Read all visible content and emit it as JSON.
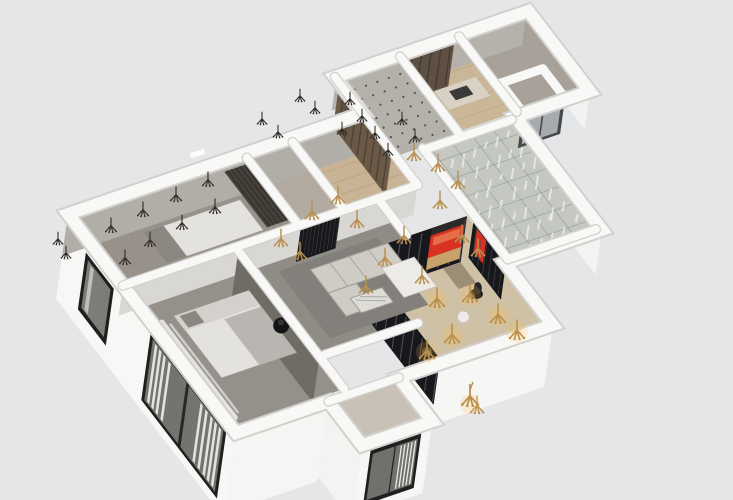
{
  "meta": {
    "title": "3D isometric cutaway rendering of an apartment floor plan",
    "style": "sketchup-axonometric-dollhouse"
  },
  "palette": {
    "background": "#e5e6e7",
    "wallTop": "#f8f8f6",
    "wallUnder": "#d2d1ce",
    "extFace": "#f3f3f1",
    "nwFace": "#b1ada7",
    "interiorFace": "#d9d7d3",
    "tvWall": "#6f6b65",
    "frameDark": "#1e1f1e",
    "windowGlass": "#6f726c",
    "curtain": "#ffffff",
    "partition": "#17181b",
    "mullion": "#4a4c50",
    "redAccent": "#d93222",
    "benchWood": "#c9a26b",
    "lintel": "#2b2a28",
    "gold": "#b8904f",
    "darkIcon": "#3a332b",
    "woodFloor": "#c8b494",
    "plankLine": "#b09c7d",
    "ceiling": "#b4b0aa",
    "ceilingDot": "#56504a",
    "court": "#c4c8c1",
    "courtLine": "rgba(100,105,100,0.28)",
    "cabinet": "#5e5042",
    "cabinetLine": "#473c31",
    "counter": "#d8d1c4",
    "sink": "#3a3a38",
    "elevatorDoor": "#a7abae",
    "elevatorFrame": "#45484c",
    "sofa": "#cfccc6",
    "sofaLine": "#a09c96",
    "rug": "#837f7a",
    "marble": "#dedcd7",
    "marbleVein": "#9f9d98",
    "bed": "#e4e2de",
    "blanket": "#b9b6b1",
    "pillow": "#8a8680",
    "wardrobe": "#46403a",
    "daybed": "#edebe7",
    "deskWood": "#9c8d76",
    "black": "#141416"
  },
  "rooms": [
    {
      "id": "bedroom-north",
      "floor": "#97918a"
    },
    {
      "id": "closet",
      "floor": "#b2aa9f"
    },
    {
      "id": "entry-hall",
      "floor": "#c8b494"
    },
    {
      "id": "kitchen",
      "floor": "#cab797"
    },
    {
      "id": "top-right-room",
      "floor": "#a7a19a"
    },
    {
      "id": "glass-court",
      "floor": "#c4c8c1"
    },
    {
      "id": "living-room",
      "floor": "#8f8b85"
    },
    {
      "id": "master-bedroom",
      "floor": "#95908a"
    },
    {
      "id": "study",
      "floor": "#cfc1a5"
    },
    {
      "id": "bathroom",
      "floor": "#c9c1b5"
    }
  ],
  "lights": {
    "gold": [
      [
        312,
        213
      ],
      [
        281,
        240
      ],
      [
        300,
        253
      ],
      [
        338,
        197
      ],
      [
        357,
        221
      ],
      [
        385,
        259
      ],
      [
        404,
        237
      ],
      [
        422,
        277
      ],
      [
        366,
        287
      ],
      [
        414,
        154
      ],
      [
        438,
        165
      ],
      [
        440,
        202
      ],
      [
        458,
        182
      ],
      [
        462,
        236
      ],
      [
        478,
        250
      ],
      [
        477,
        407
      ]
    ],
    "gold_glow": [
      [
        437,
        300
      ],
      [
        470,
        295
      ],
      [
        517,
        332
      ],
      [
        427,
        352
      ],
      [
        498,
        316
      ],
      [
        452,
        336
      ]
    ],
    "dark_floor": [
      [
        111,
        227
      ],
      [
        143,
        211
      ],
      [
        176,
        196
      ],
      [
        208,
        181
      ],
      [
        150,
        241
      ],
      [
        182,
        224
      ],
      [
        215,
        208
      ],
      [
        125,
        259
      ]
    ],
    "dark_wall": [
      [
        350,
        100
      ],
      [
        362,
        117
      ],
      [
        375,
        134
      ],
      [
        388,
        151
      ],
      [
        342,
        130
      ],
      [
        402,
        120
      ],
      [
        415,
        137
      ],
      [
        300,
        97
      ],
      [
        315,
        109
      ],
      [
        262,
        120
      ],
      [
        278,
        133
      ],
      [
        58,
        240
      ],
      [
        66,
        254
      ]
    ],
    "pendant": [
      470,
      398
    ]
  }
}
